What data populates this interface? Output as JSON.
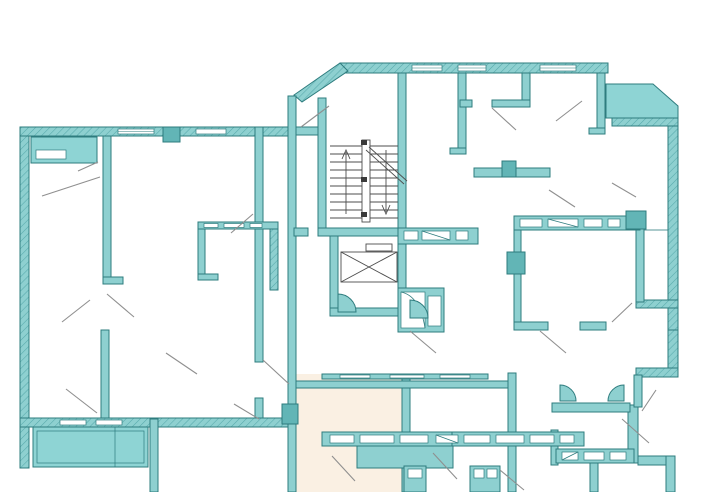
{
  "page": {
    "type": "architectural-floor-plan-drawing",
    "visible_text": [],
    "notes": "multi-unit residential floor plan, no text labels rendered in image"
  },
  "colors": {
    "background": "#ffffff",
    "wall_fill": "#8ed0d0",
    "wall_stroke": "#2e7c7e",
    "balcony_fill": "#8ed4d4",
    "column_fill": "#62b5b6",
    "highlight_room_fill": "#faf0e3",
    "hatch_line": "#57a9ab",
    "stair_line": "#4d4d4d",
    "door_swing_line": "#8f8f8f"
  },
  "plan": {
    "core": {
      "staircase": "double-flight with up and down arrows and center stringer",
      "elevator": "shaft with crossed rectangle car symbol"
    },
    "balconies": [
      "top-left",
      "top-right-chamfered",
      "bottom-left"
    ],
    "highlighted_unit_location": "bottom-center",
    "symbols": [
      "door-swing-lines",
      "window-slot-bands",
      "hatched-exterior-walls",
      "bathroom-fixtures",
      "structural-columns"
    ]
  }
}
